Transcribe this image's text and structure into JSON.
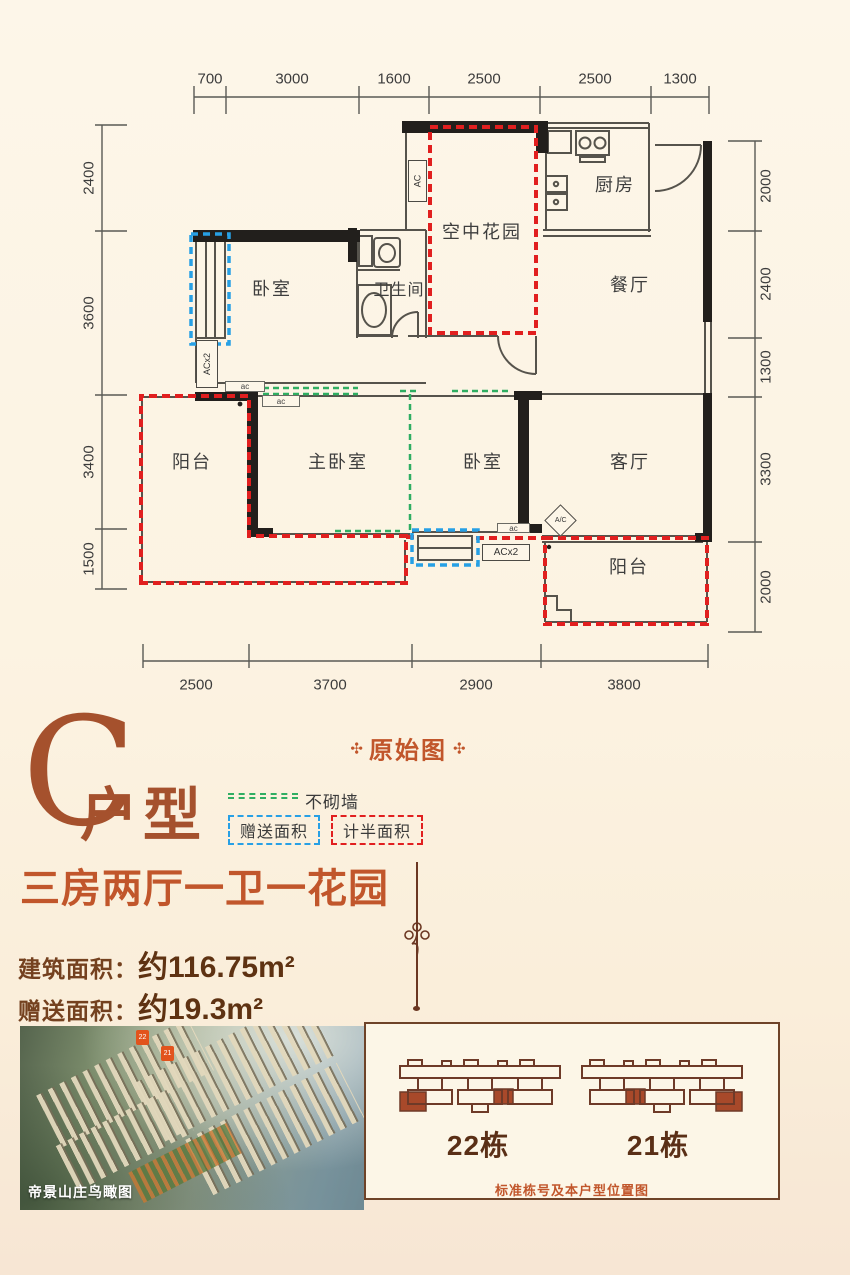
{
  "plan": {
    "dims": {
      "top": [
        "700",
        "3000",
        "1600",
        "2500",
        "2500",
        "1300"
      ],
      "left": [
        "2400",
        "3600",
        "3400",
        "1500"
      ],
      "right": [
        "2000",
        "2400",
        "1300",
        "3300",
        "2000"
      ],
      "bottom": [
        "2500",
        "3700",
        "2900",
        "3800"
      ]
    },
    "rooms": {
      "bedroom1": "卧室",
      "bathroom": "卫生间",
      "sky_garden": "空中花园",
      "kitchen": "厨房",
      "dining": "餐厅",
      "balcony_left": "阳台",
      "master_bedroom": "主卧室",
      "bedroom2": "卧室",
      "living": "客厅",
      "balcony_right": "阳台"
    },
    "ac": {
      "vertical_ac": "AC",
      "vertical_acx2": "ACx2",
      "bottom_acx2": "ACx2",
      "small_ac": "ac",
      "diamond": "A/C"
    }
  },
  "legend": {
    "badge": "原始图",
    "badge_ornament": "✣",
    "no_wall": "不砌墙",
    "gift_area": "赠送面积",
    "half_area": "计半面积"
  },
  "title": {
    "letter": "C",
    "type": "户型",
    "subtitle": "三房两厅一卫一花园"
  },
  "areas": {
    "build_label": "建筑面积：",
    "build_value": "约116.75m²",
    "gift_label": "赠送面积：",
    "gift_value": "约19.3m²"
  },
  "footer": {
    "photo_caption": "帝景山庄鸟瞰图",
    "marker_22": "22",
    "marker_21": "21",
    "building_left": "22栋",
    "building_right": "21栋",
    "panel_caption": "标准栋号及本户型位置图"
  },
  "colors": {
    "accent_rust": "#a5512d",
    "accent_orange": "#c1562b",
    "text_brown": "#5e3212",
    "dash_red": "#e11f1f",
    "dash_blue": "#27a0e5",
    "dash_green": "#2fae62",
    "wall_black": "#221f1c",
    "background_cream": "#fcf3e2"
  }
}
